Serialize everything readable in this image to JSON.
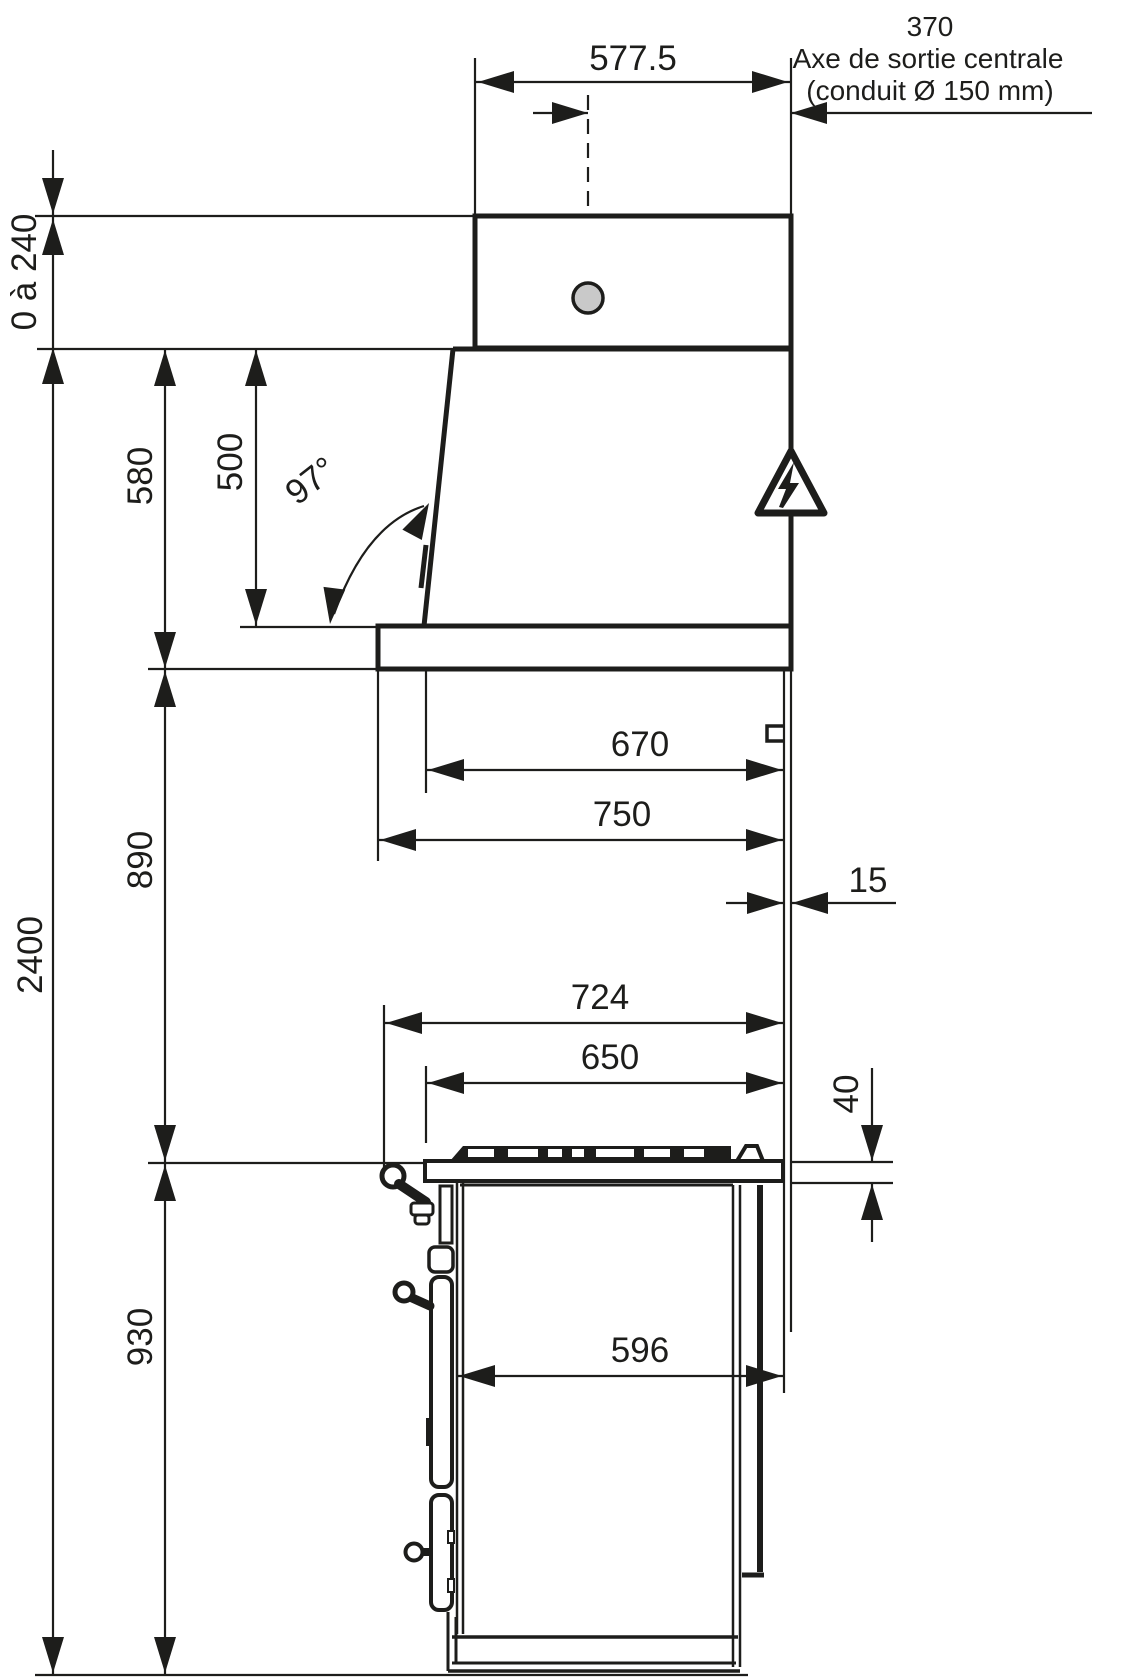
{
  "annotations": {
    "duct_offset_value": "370",
    "duct_axis_line1": "Axe de sortie centrale",
    "duct_axis_line2": "(conduit Ø 150 mm)"
  },
  "dimensions": {
    "chimney_width": "577.5",
    "adjustable_height": "0 à 240",
    "hood_total_height": "580",
    "hood_body_height": "500",
    "visor_angle": "97°",
    "overall_height": "2400",
    "hood_inner_depth": "670",
    "hood_shelf_depth": "750",
    "hood_to_worktop": "890",
    "wall_clearance": "15",
    "overall_depth": "724",
    "hob_depth": "650",
    "worktop_thickness": "40",
    "range_height": "930",
    "body_depth": "596"
  },
  "colors": {
    "line": "#1d1d1b",
    "duct_fill": "#c9c9c9",
    "background": "#ffffff"
  }
}
